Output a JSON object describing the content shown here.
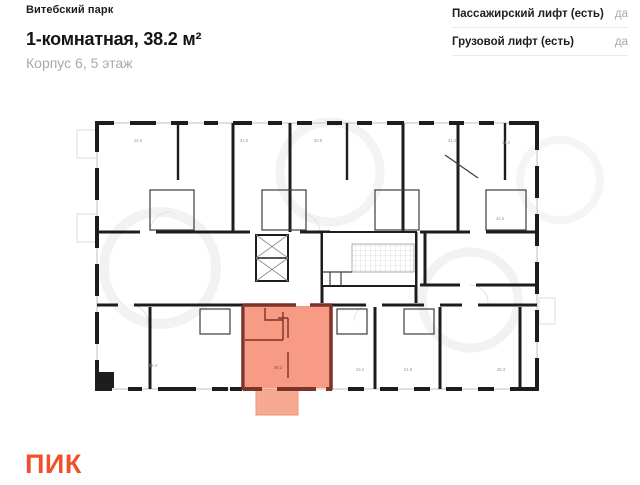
{
  "header": {
    "project": "Витебский парк",
    "title": "1-комнатная, 38.2 м²",
    "subtitle": "Корпус 6, 5 этаж"
  },
  "amenities": [
    {
      "label": "Пассажирский лифт (есть)",
      "value": "да"
    },
    {
      "label": "Грузовой лифт (есть)",
      "value": "да"
    }
  ],
  "plan": {
    "highlighted_unit": "1-комнатная, 38.2 м², Корпус 6, 5 этаж",
    "highlight_area_label": "38.2",
    "area_labels": [
      {
        "text": "44.6",
        "x": 138,
        "y": 142
      },
      {
        "text": "31.6",
        "x": 244,
        "y": 142
      },
      {
        "text": "30.8",
        "x": 318,
        "y": 142
      },
      {
        "text": "31.4",
        "x": 452,
        "y": 142
      },
      {
        "text": "34.0",
        "x": 506,
        "y": 144
      },
      {
        "text": "44.5",
        "x": 500,
        "y": 220
      },
      {
        "text": "39.4",
        "x": 153,
        "y": 367
      },
      {
        "text": "38.2",
        "x": 278,
        "y": 369
      },
      {
        "text": "33.2",
        "x": 360,
        "y": 371
      },
      {
        "text": "21.8",
        "x": 408,
        "y": 371
      },
      {
        "text": "38.3",
        "x": 501,
        "y": 371
      }
    ]
  },
  "footer": {
    "logo": "ПИК"
  },
  "colors": {
    "accent": "#f2502b",
    "highlight_fill": "#f89b85",
    "highlight_wall": "#7c3328",
    "wall": "#1d1d1d",
    "muted": "#a9a9a9",
    "divider": "#e9e9e9"
  }
}
